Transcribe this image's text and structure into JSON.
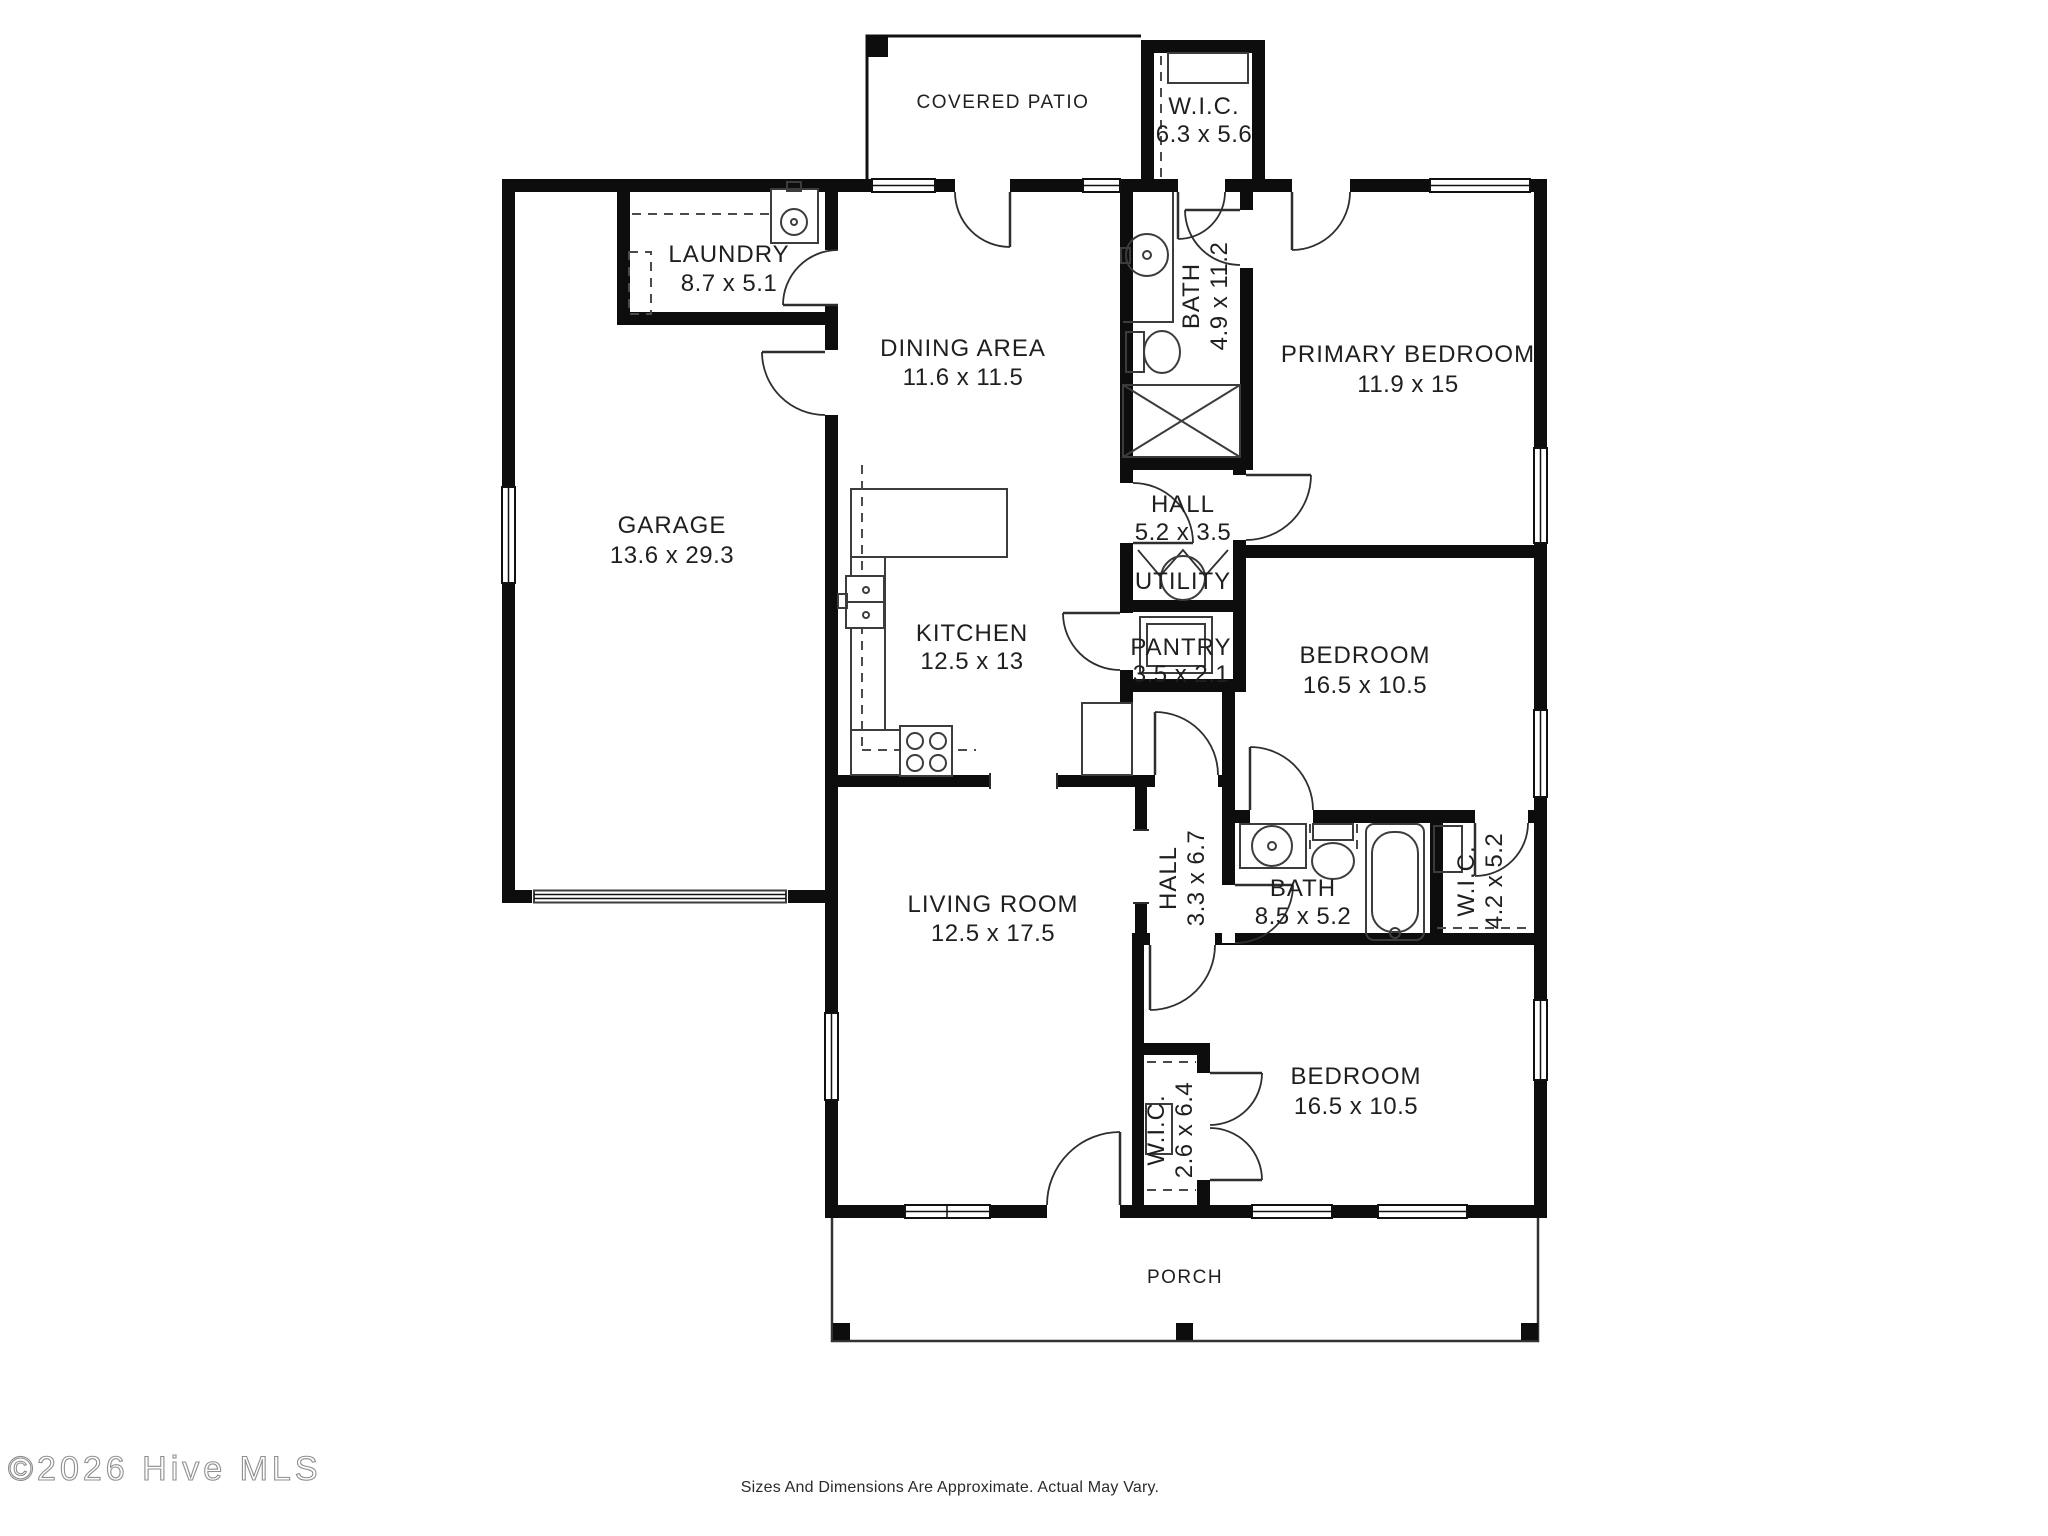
{
  "rooms": {
    "covered_patio": {
      "name": "COVERED PATIO",
      "dims": ""
    },
    "wic_primary": {
      "name": "W.I.C.",
      "dims": "6.3 x 5.6"
    },
    "laundry": {
      "name": "LAUNDRY",
      "dims": "8.7 x 5.1"
    },
    "dining": {
      "name": "DINING AREA",
      "dims": "11.6 x 11.5"
    },
    "bath_primary": {
      "name": "BATH",
      "dims": "4.9 x 11.2"
    },
    "primary_bedroom": {
      "name": "PRIMARY BEDROOM",
      "dims": "11.9 x 15"
    },
    "garage": {
      "name": "GARAGE",
      "dims": "13.6 x 29.3"
    },
    "hall_upper": {
      "name": "HALL",
      "dims": "5.2 x 3.5"
    },
    "utility": {
      "name": "UTILITY",
      "dims": ""
    },
    "kitchen": {
      "name": "KITCHEN",
      "dims": "12.5 x 13"
    },
    "pantry": {
      "name": "PANTRY",
      "dims": "3.5 x 2.1"
    },
    "bedroom_mid": {
      "name": "BEDROOM",
      "dims": "16.5 x 10.5"
    },
    "living": {
      "name": "LIVING ROOM",
      "dims": "12.5 x 17.5"
    },
    "hall_lower": {
      "name": "HALL",
      "dims": "3.3 x 6.7"
    },
    "bath_hall": {
      "name": "BATH",
      "dims": "8.5 x 5.2"
    },
    "wic_mid": {
      "name": "W.I.C.",
      "dims": "4.2 x 5.2"
    },
    "wic_lower": {
      "name": "W.I.C.",
      "dims": "2.6 x 6.4"
    },
    "bedroom_bottom": {
      "name": "BEDROOM",
      "dims": "16.5 x 10.5"
    },
    "porch": {
      "name": "PORCH",
      "dims": ""
    }
  },
  "footer": {
    "watermark": "©2026 Hive MLS",
    "disclaimer": "Sizes And Dimensions Are Approximate. Actual May Vary."
  },
  "colors": {
    "wall": "#0d0d0d",
    "background": "#ffffff",
    "text": "#1f1f1f",
    "watermark": "#8f8f8f"
  }
}
